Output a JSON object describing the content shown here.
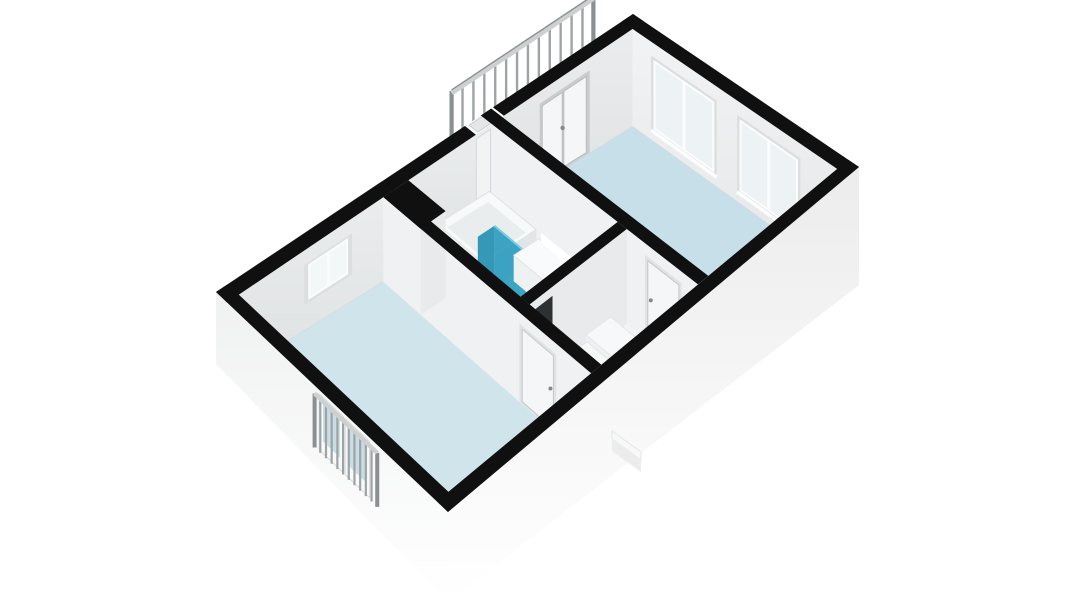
{
  "app": {
    "title": "3D floor plan render"
  },
  "scene": {
    "background": "#ffffff",
    "colors": {
      "wall_cap": "#101010",
      "int_face_nw_top": "#eaeced",
      "int_face_nw_bottom": "#dfe2e3",
      "int_face_ne_top": "#f2f3f4",
      "int_face_ne_bottom": "#e4e7e8",
      "partition_face": "#eff1f2",
      "divider_face": "#e8eaeb",
      "ext_face_sw_top": "#f0f1f1",
      "ext_face_se_top": "#ececed",
      "ext_face_bottom": "#ffffff",
      "door_leaf": "#f5f6f7",
      "door_frame": "#c9cccd",
      "door_recess": "#e0e3e4",
      "doorway_dark": "#2e3133",
      "glass_interior": "#edf3f5",
      "glass_exterior": "#c9dde4",
      "window_recess": "#dcdfe0",
      "mullion_white": "#fbfcfd",
      "railing_bar": "#9ea3a5",
      "railing_rail": "#cdd0d1",
      "railing_dark": "#8a8f91",
      "threshold_white": "#fafafa",
      "object_white_top": "#f8fafa",
      "object_side_se": "#e2e5e6",
      "object_side_sw": "#eef1f1",
      "tub_basin": "#e9edee",
      "shower_glass": "#2f9dbf",
      "shower_glass_dark": "#2791b3",
      "shower_glass_edge": "#79cde2",
      "cove_shadow": "#d5d9da",
      "handle": "#85898b"
    },
    "rooms": [
      {
        "id": "room-upper-right",
        "label": "bedroom",
        "floor_color": "#c6dfe9"
      },
      {
        "id": "room-lower-left",
        "label": "bedroom",
        "floor_color": "#cfe5eb"
      },
      {
        "id": "bathroom",
        "label": "bathroom",
        "floor_color": "#f2f4f5"
      },
      {
        "id": "hallway",
        "label": "hallway",
        "floor_color": "#f3f4f5"
      }
    ],
    "objects": [
      {
        "id": "balcony-railing-north"
      },
      {
        "id": "balcony-railing-south"
      },
      {
        "id": "french-door-north"
      },
      {
        "id": "french-door-south"
      },
      {
        "id": "window-ne-1"
      },
      {
        "id": "window-ne-2"
      },
      {
        "id": "window-nw"
      },
      {
        "id": "bathtub"
      },
      {
        "id": "shower-screen"
      },
      {
        "id": "vanity"
      },
      {
        "id": "staircase"
      },
      {
        "id": "chimney-box"
      }
    ]
  }
}
